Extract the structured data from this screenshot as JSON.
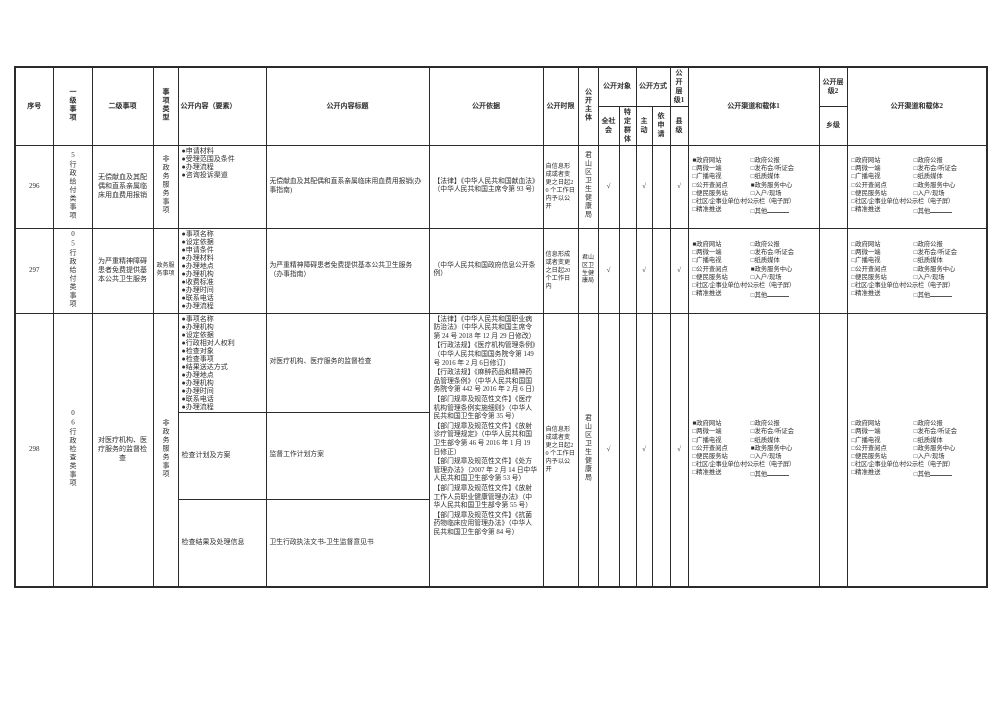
{
  "page": {
    "background": "#ffffff",
    "text_color": "#2e2e2e",
    "border_color": "#2b2b2b"
  },
  "table": {
    "header": {
      "no": "序号",
      "level1": "一级事项",
      "level2": "二级事项",
      "type": "事项类型",
      "content": "公开内容（要素）",
      "title": "公开内容标题",
      "basis": "公开依据",
      "time": "公开时限",
      "subject": "公开主体",
      "target": "公开对象",
      "all": "全社会",
      "specific": "特定群体",
      "mode": "公开方式",
      "active": "主动",
      "request": "依申请",
      "tier1": "公开层级1",
      "county": "县级",
      "channels1": "公开渠道和载体1",
      "tier2": "公开层级2",
      "town": "乡级",
      "channels2": "公开渠道和载体2"
    },
    "symbols": {
      "checked": "■",
      "unchecked": "□",
      "check": "√",
      "bullet": "●"
    },
    "channel_lines": [
      [
        {
          "label": "政府网站"
        },
        {
          "label": "政府公报"
        }
      ],
      [
        {
          "label": "两微一端"
        },
        {
          "label": "发布会/听证会"
        }
      ],
      [
        {
          "label": "广播电视"
        },
        {
          "label": "纸质媒体"
        }
      ],
      [
        {
          "label": "公开查阅点"
        },
        {
          "label": "政务服务中心"
        }
      ],
      [
        {
          "label": "便民服务站"
        },
        {
          "label": "入户/现场"
        }
      ],
      [
        {
          "label": "社区/企事业单位/村公示栏（电子屏）"
        }
      ],
      [
        {
          "label": "精准推送"
        },
        {
          "label": "其他",
          "u": true
        }
      ]
    ],
    "rows": [
      {
        "no": "296",
        "level1": "5行政给付类事项",
        "level1_vertical": true,
        "level2": "无偿献血及其配偶和直系亲属临床用血费用报销",
        "type": "非政务服务事项",
        "type_vertical": true,
        "subject": "君山区卫生健康局",
        "subject_vertical": true,
        "time_limit": "自信息形成或者变更之日起20 个工作日内予以公开",
        "basis": [
          "【法律】《中华人民共和国献血法》（中华人民共和国主席令第 93 号）"
        ],
        "checks": {
          "all": true,
          "specific": false,
          "active": true,
          "request": false,
          "county": true,
          "town": false
        },
        "channels1_checked": [
          "政府网站",
          "政务服务中心"
        ],
        "channels2_checked": [],
        "subrows": [
          {
            "bullets": [
              "申请材料",
              "受理范围及条件",
              "办理流程",
              "咨询投诉渠道"
            ],
            "title": "无偿献血及其配偶和直系亲属临床用血费用报销(办事指南)",
            "height": 83
          }
        ]
      },
      {
        "no": "297",
        "level1": "05行政给付类事项",
        "level1_vertical": true,
        "level2": "为严重精神障碍患者免费提供基本公共卫生服务",
        "type": "政务服务事项",
        "type_vertical": false,
        "subject": "君山区卫生健康局",
        "subject_vertical": false,
        "time_limit": "信息形成或者变更之日起20个工作日内",
        "basis": [
          "（中华人民共和国政府信息公开条例）"
        ],
        "checks": {
          "all": true,
          "specific": false,
          "active": true,
          "request": false,
          "county": true,
          "town": false
        },
        "channels1_checked": [
          "政府网站",
          "政务服务中心"
        ],
        "channels2_checked": [],
        "subrows": [
          {
            "bullets": [
              "事项名称",
              "设定依据",
              "申请条件",
              "办理材料",
              "办理地点",
              "办理机构",
              "收费标准",
              "办理时间",
              "联系电话",
              "办理流程"
            ],
            "title": "为严重精神障碍患者免费提供基本公共卫生服务 （办事指南）",
            "height": 85
          }
        ]
      },
      {
        "no": "298",
        "level1": "06行政检查类事项",
        "level1_vertical": true,
        "level2": "对医疗机构、医疗服务的监督检查",
        "type": "非政务服务事项",
        "type_vertical": true,
        "subject": "君山区卫生健康局",
        "subject_vertical": true,
        "time_limit": "自信息形成或者变更之日起20 个工作日内予以公开",
        "basis": [
          "【法律】《中华人民共和国职业病防治法》（中华人民共和国主席令第 24 号 2018 年 12 月 29 日修改）",
          "【行政法规】《医疗机构管理条例》（中华人民共和国国务院令第 149 号 2016 年 2 月 6日修订）",
          "【行政法规】《麻醉药品和精神药品管理条例》（中华人民共和国国务院令第 442 号 2016 年 2 月 6 日）",
          "【部门规章及规范性文件】《医疗机构管理条例实施细则》（中华人民共和国卫生部令第 35 号）",
          "【部门规章及规范性文件】《放射诊疗管理规定》（中华人民共和国卫生部令第 46 号 2016 年 1 月 19 日修正）",
          "【部门规章及规范性文件】《处方管理办法》（2007 年 2 月 14 日中华人民共和国卫生部令第 53 号）",
          "【部门规章及规范性文件】《放射工作人员职业健康管理办法》（中华人民共和国卫生部令第 55 号）",
          "【部门规章及规范性文件】《抗菌药物临床应用管理办法》（中华人民共和国卫生部令第 84 号）"
        ],
        "checks": {
          "all": true,
          "specific": false,
          "active": true,
          "request": false,
          "county": true,
          "town": false
        },
        "channels1_checked": [
          "政府网站",
          "政务服务中心"
        ],
        "channels2_checked": [],
        "subrows": [
          {
            "bullets": [
              "事项名称",
              "办理机构",
              "设定依据",
              "行政相对人权利",
              "检查对象",
              "检查事项",
              "结果送达方式",
              "办理地点",
              "办理机构",
              "办理时间",
              "联系电话",
              "办理流程"
            ],
            "title": "对医疗机构、医疗服务的监督检查",
            "height": 98
          },
          {
            "text": "检查计划及方案",
            "title": "监督工作计划方案",
            "height": 87
          },
          {
            "text": "检查结果及处理信息",
            "title": "卫生行政执法文书-卫生监督意见书",
            "height": 88
          }
        ]
      }
    ]
  }
}
